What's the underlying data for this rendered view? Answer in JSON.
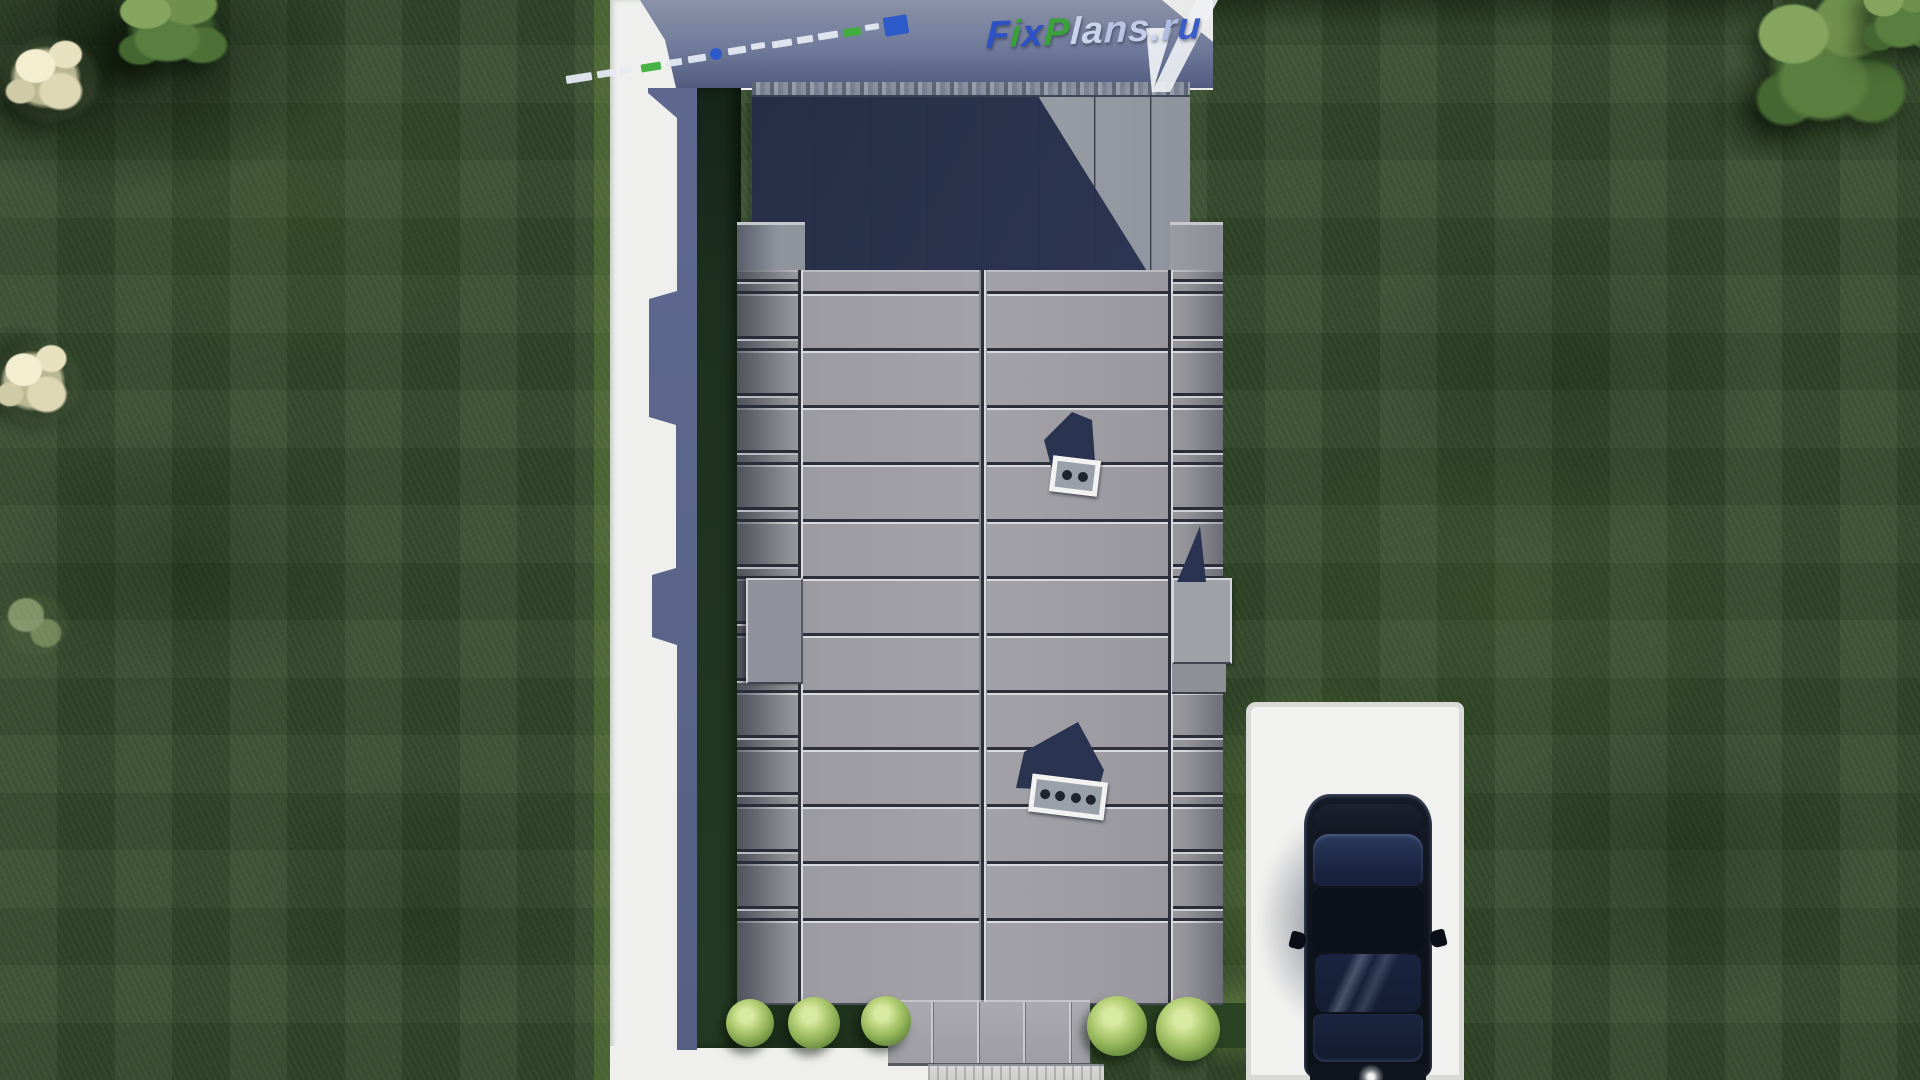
{
  "watermark": {
    "logo_text": "FixPlans.ru",
    "logo_letters": [
      {
        "ch": "F",
        "color": "#2d52c6"
      },
      {
        "ch": "i",
        "color": "#3aa23a"
      },
      {
        "ch": "x",
        "color": "#2d52c6"
      },
      {
        "ch": "P",
        "color": "#3aa23a"
      },
      {
        "ch": "l",
        "color": "#c9d3ec"
      },
      {
        "ch": "a",
        "color": "#c9d3ec"
      },
      {
        "ch": "n",
        "color": "#b9c4e4"
      },
      {
        "ch": "s",
        "color": "#c3cde8"
      },
      {
        "ch": ".",
        "color": "#c9d3ec"
      },
      {
        "ch": "r",
        "color": "#b0bce0"
      },
      {
        "ch": "u",
        "color": "#3a5cc6"
      }
    ],
    "dashes": [
      {
        "x": 566,
        "y": 74,
        "w": 26,
        "h": 8,
        "type": "white"
      },
      {
        "x": 597,
        "y": 70,
        "w": 18,
        "h": 7,
        "type": "white"
      },
      {
        "x": 620,
        "y": 67,
        "w": 12,
        "h": 6,
        "type": "white"
      },
      {
        "x": 641,
        "y": 63,
        "w": 20,
        "h": 8,
        "type": "green"
      },
      {
        "x": 666,
        "y": 59,
        "w": 16,
        "h": 7,
        "type": "white"
      },
      {
        "x": 688,
        "y": 55,
        "w": 18,
        "h": 7,
        "type": "white"
      },
      {
        "x": 710,
        "y": 48,
        "w": 12,
        "h": 12,
        "type": "blue-dot"
      },
      {
        "x": 728,
        "y": 47,
        "w": 18,
        "h": 7,
        "type": "white"
      },
      {
        "x": 751,
        "y": 43,
        "w": 14,
        "h": 6,
        "type": "white"
      },
      {
        "x": 772,
        "y": 40,
        "w": 20,
        "h": 7,
        "type": "white"
      },
      {
        "x": 797,
        "y": 36,
        "w": 16,
        "h": 7,
        "type": "white"
      },
      {
        "x": 818,
        "y": 32,
        "w": 20,
        "h": 7,
        "type": "white"
      },
      {
        "x": 843,
        "y": 28,
        "w": 18,
        "h": 8,
        "type": "green"
      },
      {
        "x": 865,
        "y": 24,
        "w": 14,
        "h": 6,
        "type": "white"
      },
      {
        "x": 884,
        "y": 16,
        "w": 24,
        "h": 19,
        "type": "blue-square"
      }
    ]
  },
  "scene": {
    "colors": {
      "lawn_base": "#33492b",
      "pavement": "#f1f1ef",
      "roof_light": "#a3a2a8",
      "roof_shadow": "#27304b",
      "ground_shadow": "#5f6990",
      "car_body": "#10141e",
      "bush_light": "#d8e9a2"
    },
    "bushes": [
      {
        "x": 726,
        "y": 999,
        "d": 48
      },
      {
        "x": 788,
        "y": 997,
        "d": 52
      },
      {
        "x": 861,
        "y": 996,
        "d": 50
      },
      {
        "x": 1087,
        "y": 996,
        "d": 60
      },
      {
        "x": 1156,
        "y": 997,
        "d": 64
      }
    ],
    "trees": [
      {
        "type": "tree-shadow",
        "x": -30,
        "y": 40,
        "w": 120,
        "h": 120
      },
      {
        "type": "tree-shadow",
        "x": 60,
        "y": 5,
        "w": 130,
        "h": 110
      },
      {
        "type": "tree-shadow",
        "x": 1688,
        "y": 40,
        "w": 160,
        "h": 140
      },
      {
        "type": "tree-shadow",
        "x": -35,
        "y": 310,
        "w": 110,
        "h": 110
      },
      {
        "type": "tree-white",
        "x": -12,
        "y": 20,
        "w": 125,
        "h": 115
      },
      {
        "type": "tree-green",
        "x": 105,
        "y": -20,
        "w": 135,
        "h": 105
      },
      {
        "type": "tree-white",
        "x": -20,
        "y": 325,
        "w": 115,
        "h": 112
      },
      {
        "type": "tree-faint",
        "x": -14,
        "y": 575,
        "w": 100,
        "h": 100
      },
      {
        "type": "tree-green",
        "x": 1738,
        "y": -20,
        "w": 185,
        "h": 180
      },
      {
        "type": "tree-green",
        "x": 1852,
        "y": -30,
        "w": 105,
        "h": 100
      }
    ]
  }
}
